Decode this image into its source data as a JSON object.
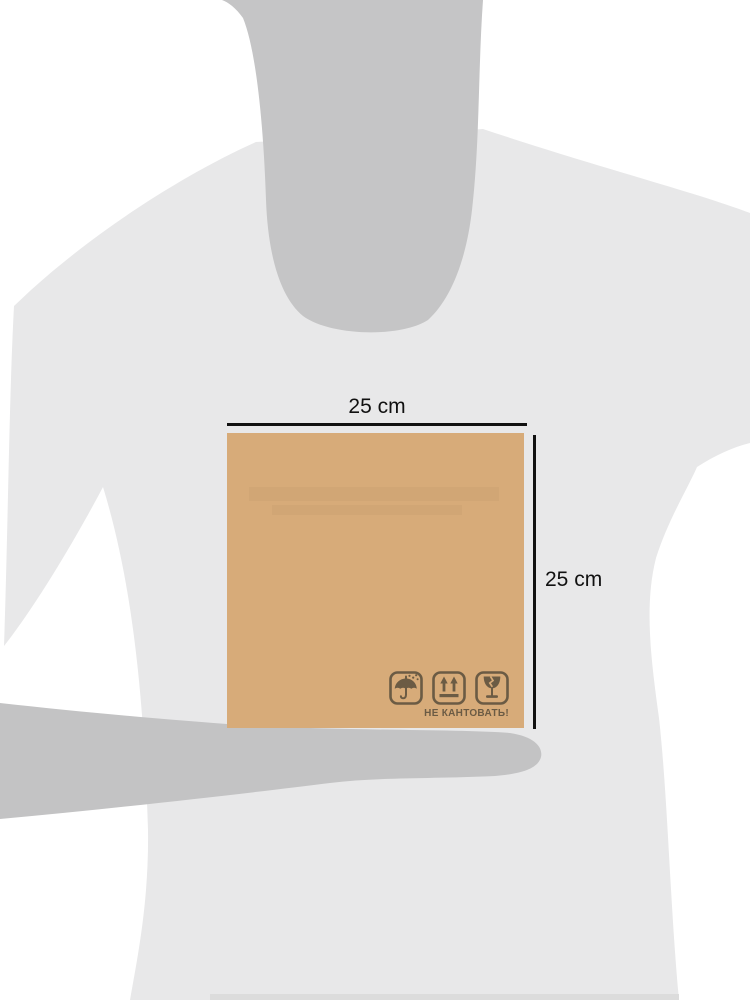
{
  "title": "Person holding cardboard box with dimensions",
  "colors": {
    "background": "#ffffff",
    "shirt": "#e8e8e9",
    "shirt_shadow": "#dcdcdc",
    "skin": "#c5c5c6",
    "arm": "#c3c3c4",
    "box": "#d7ab79",
    "icon_ink": "#6b5b44",
    "dimension_line": "#111111",
    "dimension_text": "#111111"
  },
  "dimensions": {
    "width_label": "25 cm",
    "height_label": "25 cm"
  },
  "box": {
    "warning_text": "НЕ КАНТОВАТЬ!",
    "icons": [
      "keep-dry-icon",
      "this-side-up-icon",
      "fragile-icon"
    ]
  }
}
